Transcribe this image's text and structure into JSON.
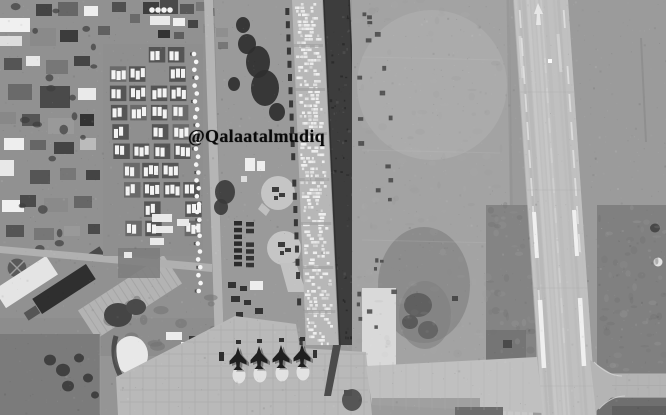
{
  "image": {
    "description": "grayscale aerial satellite photograph of an airbase"
  },
  "watermark": {
    "text": "@Qalaatalmudiq",
    "color": "#0a0a0a"
  },
  "objects": {
    "aircraft_count": 4,
    "helipad_count": 2
  },
  "palette": {
    "base_gray": "#9b9b9b",
    "urban_gray": "#919191",
    "dirt_field": "#a3a3a3",
    "runway": "#bfbfbf",
    "runway_marking": "#f2f2f2",
    "dark_strip": "#3d3d3d",
    "storage_base": "#b7b7b7",
    "crate_white": "#efefef",
    "compound_dark": "#555555",
    "tent_white": "#f3f3f3",
    "concrete": "#b9b9b9",
    "field_dark": "#7b7b7b",
    "vegetation_dark": "#3a3a3a",
    "aircraft_dark": "#1f1f1f",
    "pad_white": "#e9e9e9"
  }
}
